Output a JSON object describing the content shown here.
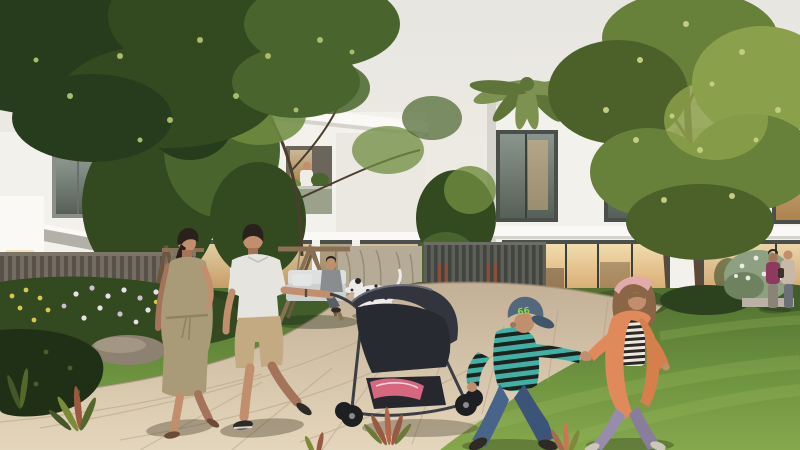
{
  "scene": {
    "type": "architectural-rendering",
    "setting": "Landscaped courtyard of a modern white townhouse community in warm evening light",
    "foreground": "Two children holding hands running on the lawn; parents pushing a baby stroller along a curved stone path",
    "midground": "Wooden swing bench with seated resident, dalmatian dog, flower beds, slatted garden fences",
    "background": "Two-storey white villas with warm lit windows, palm tree and large leafy trees",
    "boy": {
      "cap_badge": "66"
    }
  },
  "colors": {
    "sky_top": "#e8e6e1",
    "sky_low": "#f3eee2",
    "bldg_face": "#f3f1ec",
    "bldg_bright": "#fbf9f5",
    "bldg_shade": "#d6d3cc",
    "roof_gray": "#b3b0aa",
    "win_frame": "#4a4f4b",
    "win_frame_light": "#8b8e89",
    "win_warm": "#e8c288",
    "win_warm_deep": "#c98f4e",
    "glass_cool_a": "#8a958d",
    "glass_cool_b": "#566058",
    "glass_tree_a": "#7d8666",
    "glass_tree_b": "#a89f88",
    "balcony_wall": "#9aa28c",
    "fence_base": "#756d61",
    "fence_slat": "#57514a",
    "fence_dark_base": "#5d5f58",
    "fence_dark_slat": "#42443f",
    "screen_wall": "#b5ab97",
    "canopy_darkest": "#273b1d",
    "canopy_dark": "#33491f",
    "canopy_mid": "#49642c",
    "canopy_light": "#6f8c3f",
    "leaf_glow": "#a9bc6b",
    "palm": "#7d9150",
    "palm_dark": "#5f7438",
    "trunk": "#5d4a36",
    "branch_dark": "#3d3024",
    "tree_olive": "#67803a",
    "tree_olive_light": "#8ba04a",
    "tree_olive_dark": "#4c6129",
    "leaf_speckle": "#c2cc82",
    "hedge": "#2c421f",
    "hedge_light": "#415d2a",
    "flower_white": "#e7e1e9",
    "flower_lavender": "#cbbfd6",
    "flower_yellow": "#d9c54f",
    "rock": "#8d8171",
    "rock_light": "#a79a86",
    "grass_far": "#4f7030",
    "grass_mid": "#6e9340",
    "grass_near": "#86a84c",
    "grass_streak": "#9ab95c",
    "path_far": "#c3b096",
    "path_near": "#e4d6bc",
    "path_joint": "#ad9a7e",
    "wood": "#8a7154",
    "wood_dark": "#6b573f",
    "cushion": "#ccd0cf",
    "cushion_light": "#dde0de",
    "dog_white": "#ecebe7",
    "dog_spot": "#2b2927",
    "skin": "#c28f6e",
    "skin_shade": "#a3735a",
    "hair_dark": "#2a201c",
    "shirt_polo": "#e6e4df",
    "shorts_khaki": "#c4aa82",
    "shoe_dark": "#2e2a26",
    "dress_olive": "#a99b77",
    "sandal": "#6b4a38",
    "stroller_body": "#32353d",
    "stroller_seat": "#272a31",
    "stroller_frame": "#3b3e44",
    "wheel": "#1d1f21",
    "wheel_hub": "#8a8d90",
    "blanket_pink": "#d6677e",
    "cap_blue": "#53677d",
    "cap_brim": "#41556a",
    "badge_green": "#8ed24e",
    "boy_teal": "#3cb3a5",
    "boy_dark": "#221f1e",
    "jeans": "#49648a",
    "jeans_dark": "#3c5478",
    "girl_hair": "#8a6546",
    "headband": "#e2aaa9",
    "cardigan": "#e08a5c",
    "cardigan_dark": "#d57f4c",
    "stripe_light": "#ece8de",
    "stripe_dark": "#2c2824",
    "pants_lav": "#988cab",
    "pants_lav_dark": "#897d9c",
    "kid_shoe": "#cdc6bb",
    "figure_magenta": "#8e3a5e",
    "figure_tan": "#c9b8a8",
    "figure_pants": "#8a8478",
    "bench_stone": "#b9b2a4"
  }
}
